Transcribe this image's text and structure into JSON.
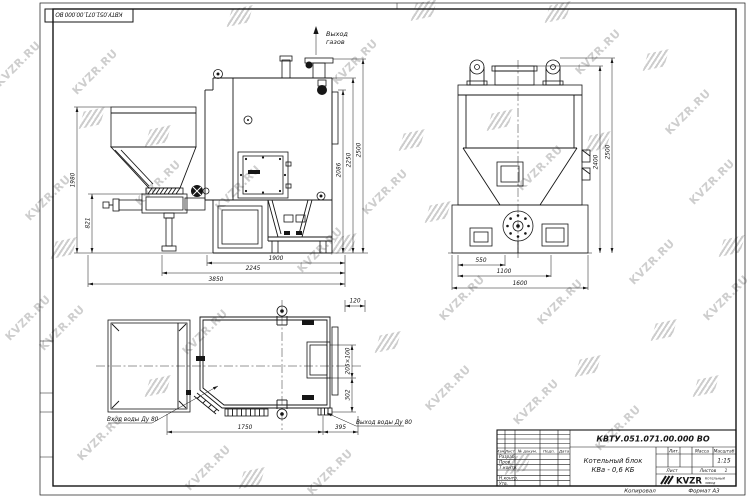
{
  "sheet": {
    "watermark_text": "KVZR.RU",
    "corner_doc_number": "КВТУ.051.071.00.000 ВО",
    "copied_label": "Копировал",
    "format_label": "Формат А3"
  },
  "annotations": {
    "gas_outlet_line1": "Выход",
    "gas_outlet_line2": "газов",
    "water_inlet": "Вход воды Ду 80",
    "water_outlet": "Выход воды Ду 80"
  },
  "dimensions": {
    "front": {
      "bottom": [
        "1900",
        "2245",
        "3850"
      ],
      "left": [
        "1980",
        "821"
      ],
      "right": [
        "2086",
        "2250",
        "2500"
      ]
    },
    "side": {
      "bottom": [
        "550",
        "1100",
        "1600"
      ],
      "right": [
        "2400",
        "2500"
      ]
    },
    "top": {
      "top_right": "120",
      "right": [
        "205×100",
        "302"
      ],
      "bottom": [
        "1750",
        "395"
      ]
    }
  },
  "title_block": {
    "doc_number": "КВТУ.051.071.00.000 ВО",
    "product_line1": "Котельный блок",
    "product_line2": "КВа - 0,6 КБ",
    "col_headers": [
      "Изм.",
      "Лист",
      "№ докум.",
      "Подп.",
      "Дата"
    ],
    "sig_rows": [
      "Разраб.",
      "Пров.",
      "Т.контр.",
      "",
      "Н.контр.",
      "Утв."
    ],
    "lit_label": "Лит.",
    "mass_label": "Масса",
    "scale_label": "Масштаб",
    "scale_value": "1:15",
    "sheet_label": "Лист",
    "sheets_label": "Листов",
    "sheets_value": "1",
    "logo_text": "KVZR",
    "logo_caption_line1": "Котельный",
    "logo_caption_line2": "завод"
  }
}
